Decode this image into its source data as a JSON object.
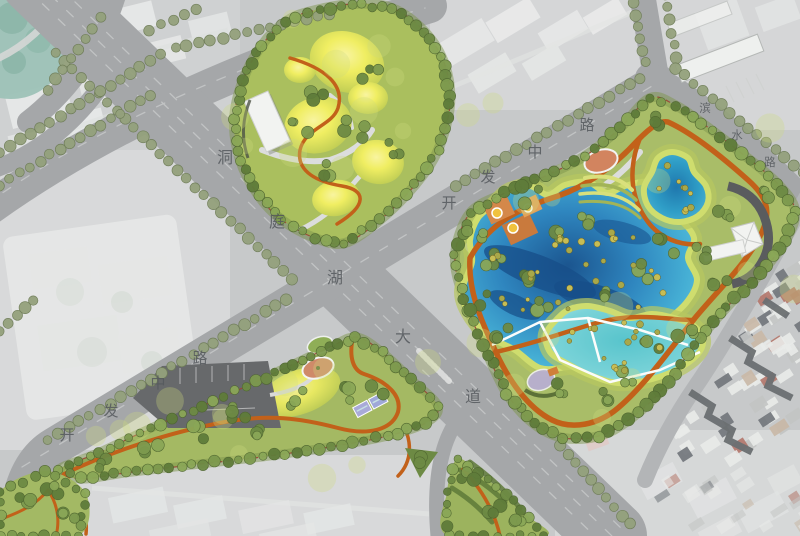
{
  "plan": {
    "kind": "landscape-masterplan-aerial",
    "roads": [
      {
        "id": "dongtinghu-avenue",
        "name": "洞庭湖大道"
      },
      {
        "id": "kaifa-middle-road-sw",
        "name": "开发中路"
      },
      {
        "id": "kaifa-middle-road-ne",
        "name": "开发中路"
      },
      {
        "id": "binshui-road",
        "name": "滨水路"
      }
    ],
    "features": {
      "central-hill-park": "yellow mounded park with winding orange path and white pavilion",
      "lake-park": "large park with three blue lakes, orange loop paths, playground, amphitheater, tent pavilion",
      "southwest-linear-park": "triangular park with parking lot, oval plaza, courts and orange path",
      "existing-city": "faded aerial photo of surrounding blocks",
      "village-rooftops": "dense small rooftops southeast of lake park"
    },
    "colors": {
      "background": "#c7c9ca",
      "road": "#a5a7a9",
      "road_minor": "#b3b5b7",
      "lane_line": "#c9cbcb",
      "street_tree": "#94a17c",
      "street_tree_edge": "#6f7d58",
      "park_green": "#a6bb66",
      "park_light": "#cdd97f",
      "tree_dark": "#6d8a44",
      "mound_yellow": "#eff065",
      "marsh_rim": "#cfdd6e",
      "lake_deep": "#1b558f",
      "lake_mid": "#2f86bf",
      "lake_light": "#4fb9d9",
      "lake_shallow": "#7ad3d8",
      "path_orange": "#c2611a",
      "plaza_salmon": "#d2845f",
      "parking": "#67696b",
      "building_white": "#f2f3f1",
      "building_dark": "#5a5c5e",
      "roof_dark": "#6b6f71",
      "boundary_dash": "#9c4434",
      "teal_corner": "#9dc2b7",
      "label_text": "#55595d"
    }
  }
}
